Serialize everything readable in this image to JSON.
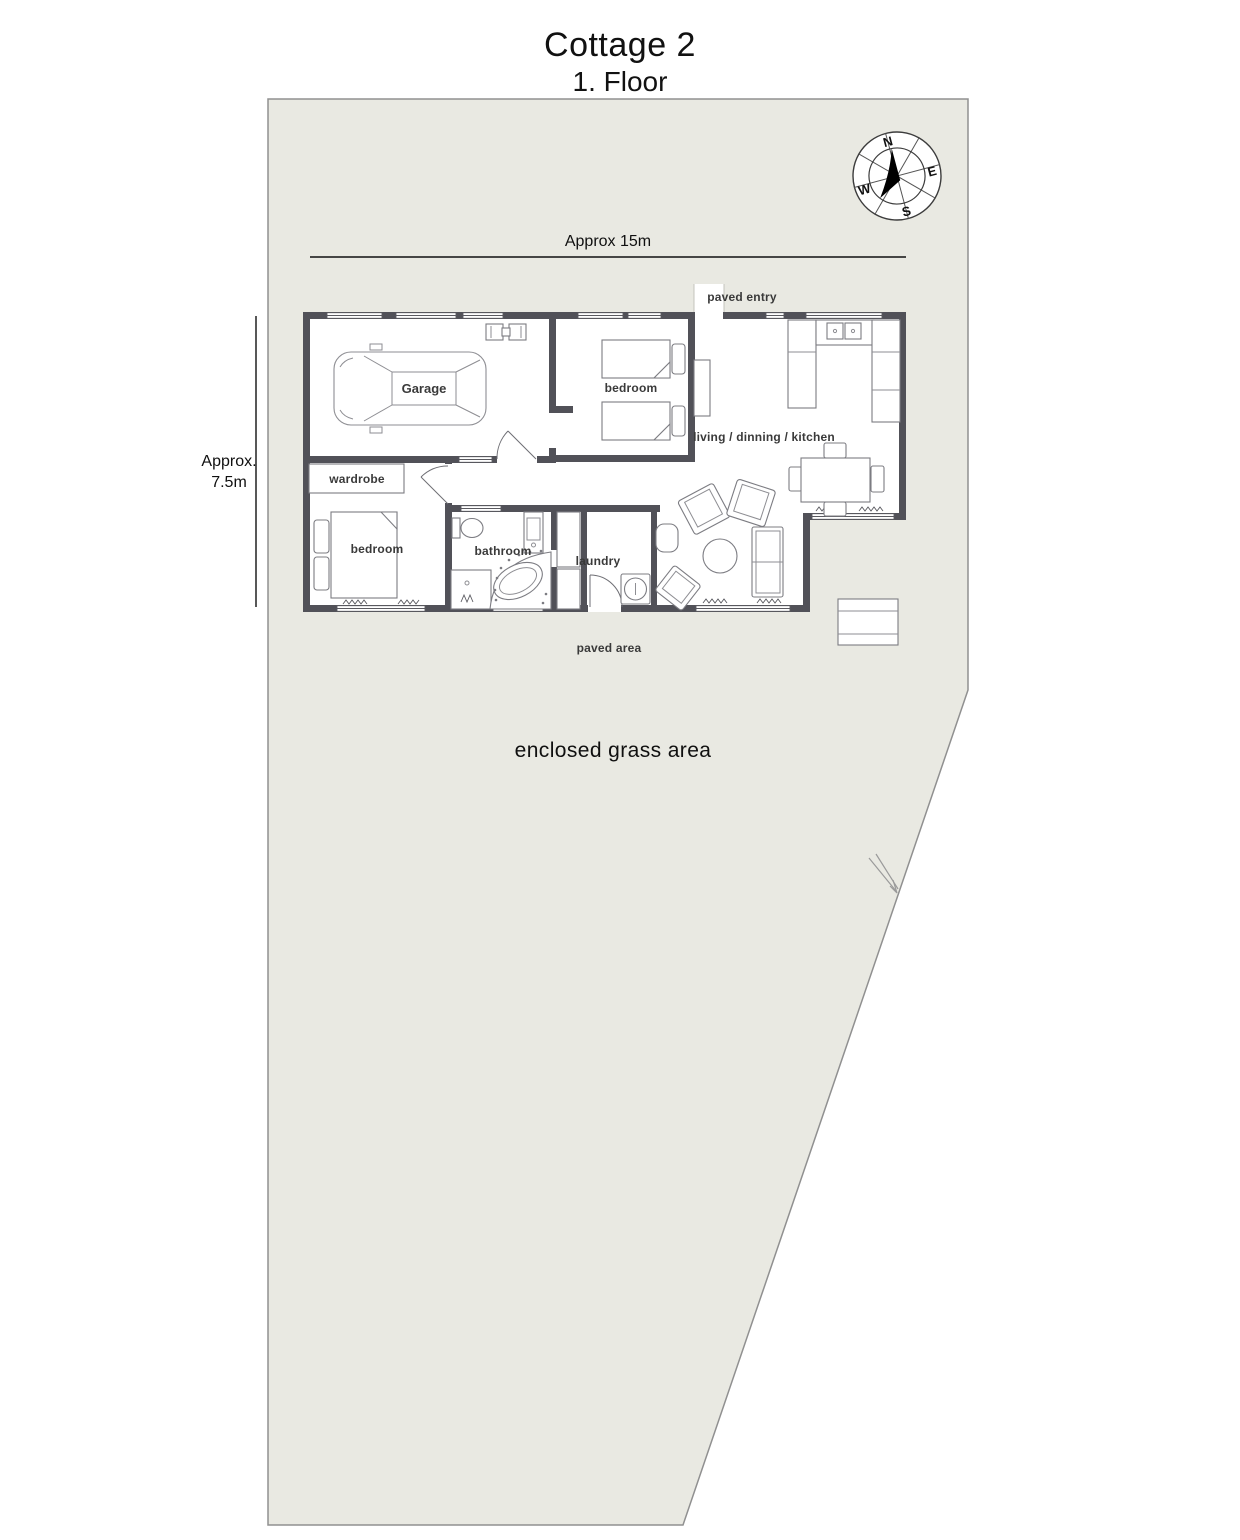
{
  "header": {
    "title": "Cottage 2",
    "subtitle": "1. Floor"
  },
  "dimensions": {
    "width_label": "Approx 15m",
    "height_label_line1": "Approx.",
    "height_label_line2": "7.5m"
  },
  "compass": {
    "n": "N",
    "e": "E",
    "s": "S",
    "w": "W"
  },
  "rooms": {
    "garage": "Garage",
    "bedroom_top": "bedroom",
    "bedroom_left": "bedroom",
    "wardrobe": "wardrobe",
    "bathroom": "bathroom",
    "laundry": "laundry",
    "living": "living / dinning / kitchen"
  },
  "outdoor": {
    "paved_entry": "paved entry",
    "paved_area": "paved area",
    "grass_area": "enclosed grass area"
  },
  "furniture": [
    "car",
    "single-bed",
    "single-bed",
    "double-bed",
    "wardrobe-unit",
    "toilet",
    "vanity",
    "shower",
    "corner-spa",
    "linen-cabinets",
    "washing-machine",
    "kitchen-counter-u",
    "sink-basins",
    "dining-table",
    "dining-chairs",
    "armchairs",
    "sofa",
    "coffee-table",
    "side-table",
    "outdoor-table"
  ],
  "colors": {
    "property_fill": "#e9e9e2",
    "property_border": "#909090",
    "wall": "#515158",
    "furniture_outline": "#7c7c82",
    "label_text": "#3a3a3a",
    "title_text": "#111111",
    "compass_needle": "#000000"
  }
}
